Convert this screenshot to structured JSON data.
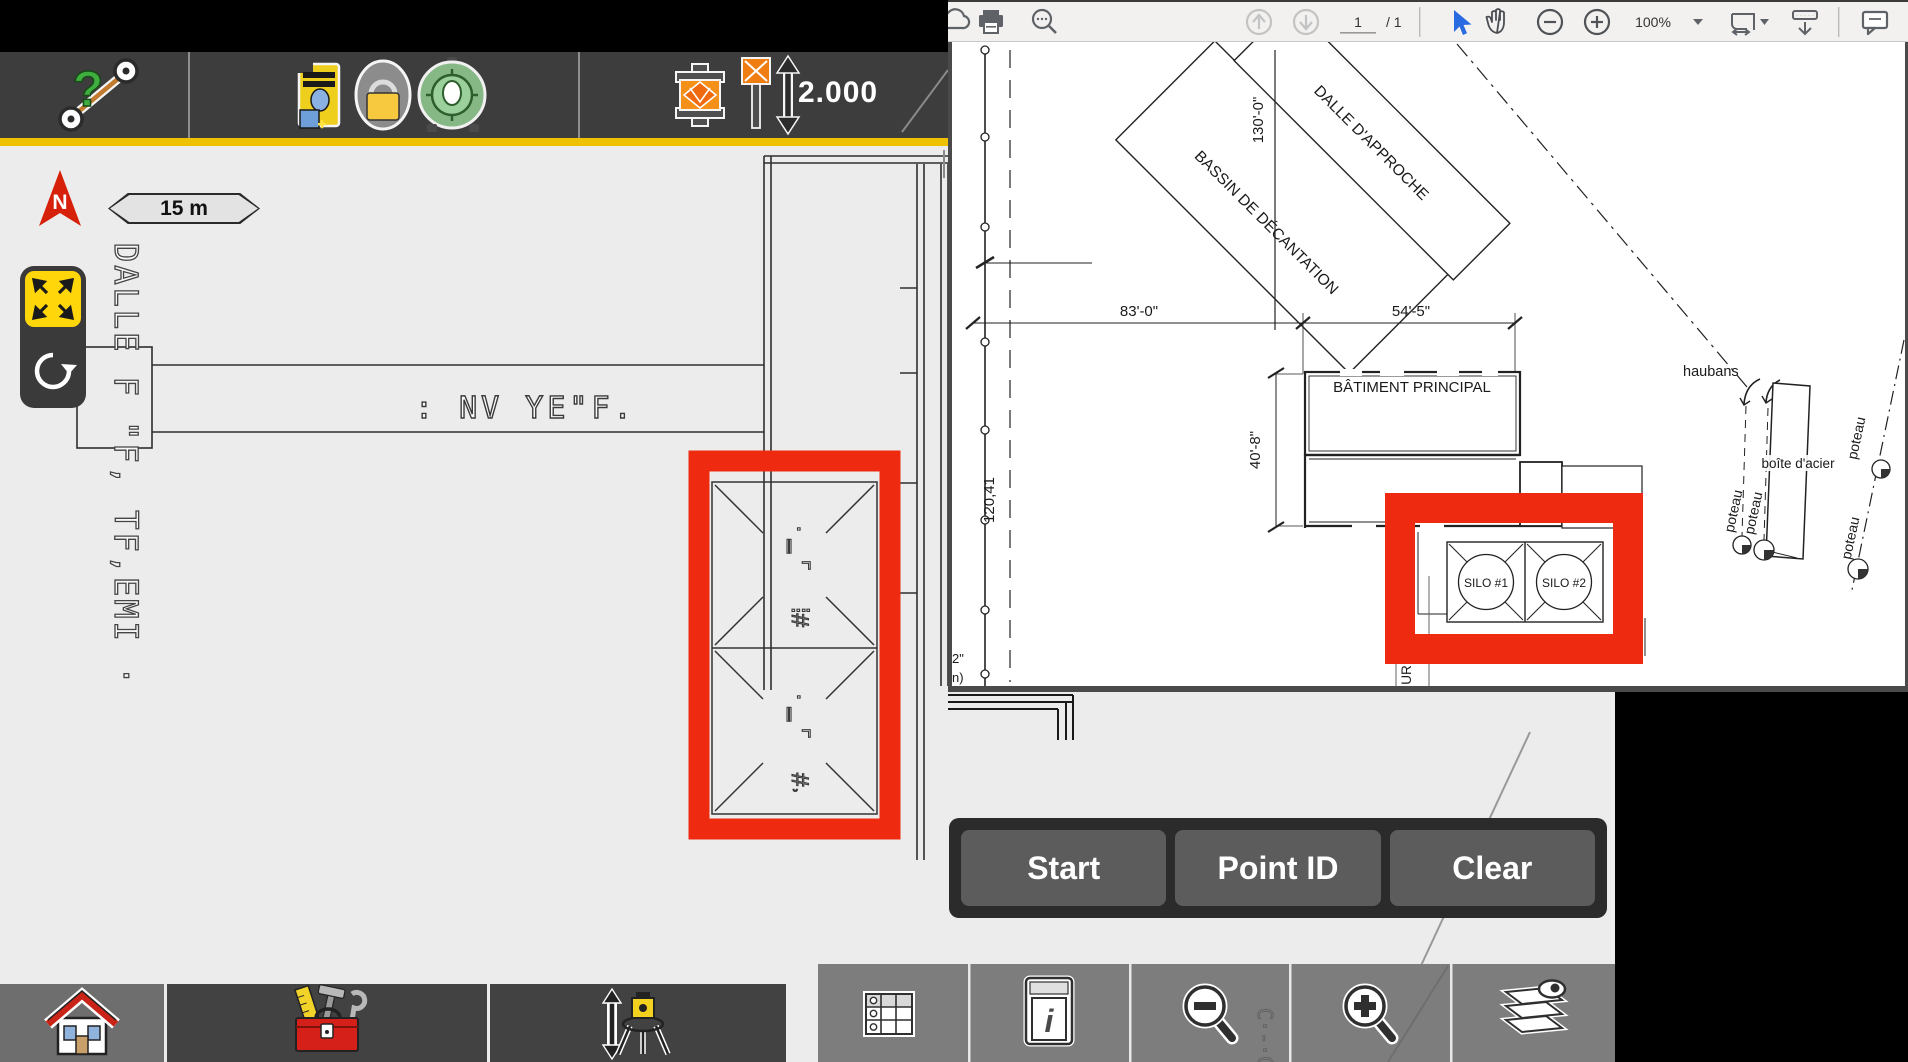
{
  "top_toolbar": {
    "help_glyph": "?",
    "pole_height": "2.000"
  },
  "map": {
    "north_label": "N",
    "scale_label": "15 m",
    "rotated_cad_text": "DALLE F  \"F, TF,EMI ·",
    "cad_text": ":  NV YE\"F.",
    "silo_glyph_1": "· ‗ ⌜",
    "silo_glyph_2": "⁞#",
    "silo_glyph_3": "· ‗ ⌜",
    "silo_glyph_4": "#˒"
  },
  "action_buttons": [
    {
      "label": "Start"
    },
    {
      "label": "Point ID"
    },
    {
      "label": "Clear"
    }
  ],
  "pdf": {
    "toolbar": {
      "page_current": "1",
      "page_total": "/ 1",
      "zoom_level": "100%"
    },
    "plan": {
      "dalle_approche": "DALLE D'APPROCHE",
      "bassin": "BASSIN DE DÉCANTATION",
      "dim_130": "130'-0\"",
      "dim_83": "83'-0\"",
      "dim_54": "54'-5\"",
      "dim_40": "40'-8\"",
      "batiment": "BÂTIMENT PRINCIPAL",
      "silo1": "SILO #1",
      "silo2": "SILO #2",
      "haubans": "haubans",
      "boite_acier": "boîte d'acier",
      "poteau": "poteau",
      "dim_120": "120,41",
      "partial_ur": "UR",
      "partial_2in": "2\"",
      "partial_n": "n)"
    }
  },
  "bottom_toolbar": {
    "info_glyph": "i",
    "faint_cad_text": "C·‐·C˪"
  },
  "colors": {
    "accent_yellow": "#eec200",
    "highlight_red": "#ee2b10",
    "toolbar_dark": "#3d3d3d",
    "selection_blue": "#2a6ae0"
  }
}
